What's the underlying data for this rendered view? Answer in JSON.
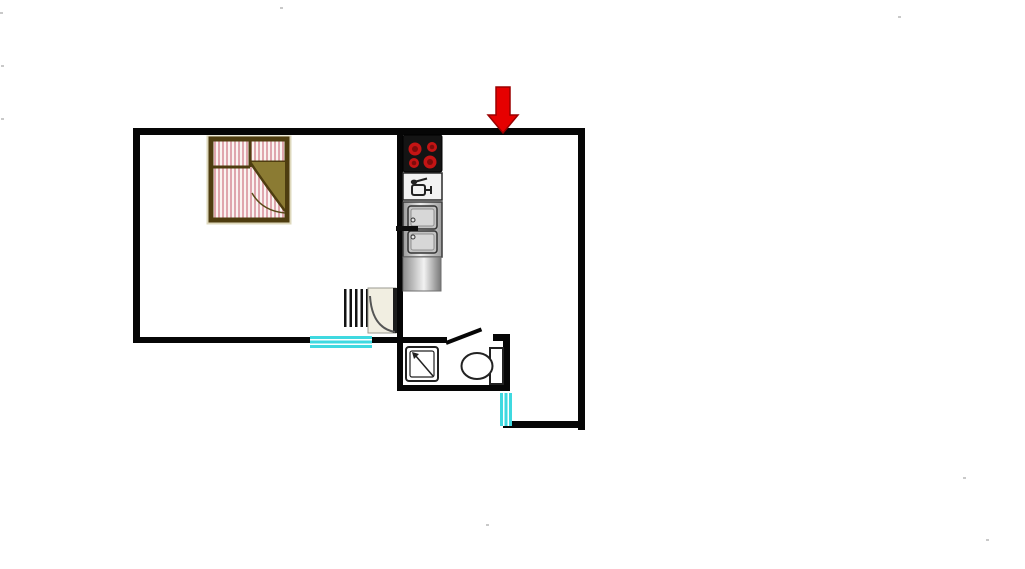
{
  "title": "One-room apartment floor plan",
  "colors": {
    "bg": "#ffffff",
    "wall": "#060606",
    "window": "#3fd9e0",
    "arrow": "#e60000",
    "arrow-edge": "#9b0000",
    "bed-frame": "#4e3d10",
    "bed-stripe": "#dfa6ae",
    "bed-stripe-bg": "#faf3f1",
    "bed-fold": "#8b7b33",
    "door-fill": "#f1eee1",
    "stove-bg": "#141414",
    "burner": "#c41414",
    "burner-core": "#7d0b0b",
    "fixture-line": "#222222"
  },
  "entrance": {
    "label": "Entrance",
    "direction": "down"
  },
  "rooms": {
    "bedroom_living": "Bedroom / living room",
    "kitchen": "Kitchen strip",
    "bathroom": "Bathroom",
    "hall": "Entrance hall"
  },
  "fixtures": {
    "bed": "Double bed with fold-back cover",
    "stove": "Cooktop with 4 burners",
    "dishwasher": "Dishwasher / appliance panel",
    "sink": "Double-basin kitchen sink with faucet",
    "counter": "Kitchen counter",
    "radiator": "Radiator (5 fins)",
    "room_door": "Interior door with swing arc",
    "bathroom_door": "Bathroom door (shown open)",
    "shower": "Shower tray with drain arrow",
    "toilet": "Toilet with cistern",
    "window_south": "Window, south wall (3 panes)",
    "window_east": "Window, lower east wall (3 panes)"
  },
  "counts": {
    "burners": 4,
    "sink_basins": 2,
    "radiator_fins": 5,
    "window_panes": 3,
    "windows": 2
  }
}
